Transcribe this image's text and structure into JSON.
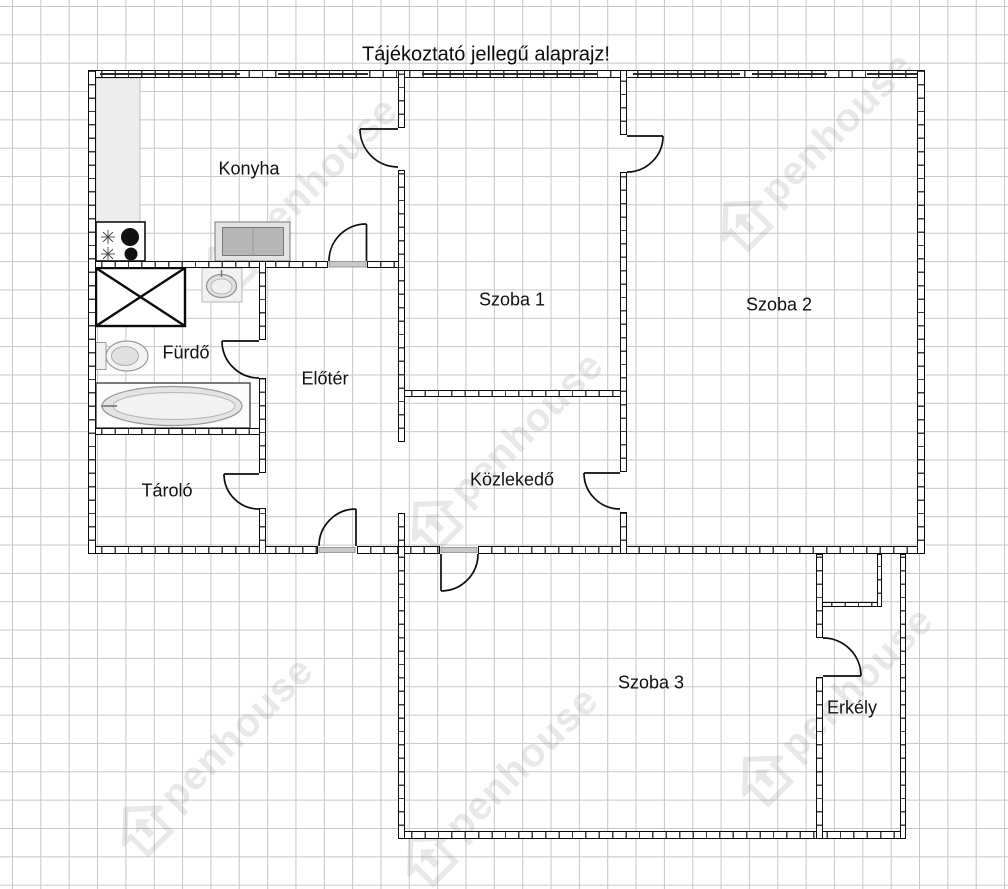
{
  "title": "Tájékoztató jellegű alaprajz!",
  "watermark": {
    "brand": "Openhouse",
    "display_text": "penhouse"
  },
  "rooms": [
    {
      "id": "konyha",
      "label": "Konyha"
    },
    {
      "id": "szoba-1",
      "label": "Szoba 1"
    },
    {
      "id": "szoba-2",
      "label": "Szoba 2"
    },
    {
      "id": "furdo",
      "label": "Fürdő"
    },
    {
      "id": "eloter",
      "label": "Előtér"
    },
    {
      "id": "kozlekedo",
      "label": "Közlekedő"
    },
    {
      "id": "tarolo",
      "label": "Tároló"
    },
    {
      "id": "szoba-3",
      "label": "Szoba 3"
    },
    {
      "id": "erkely",
      "label": "Erkély"
    }
  ],
  "fixtures": [
    "kitchen-counter",
    "stove",
    "kitchen-sink",
    "utility-shaft",
    "washbasin",
    "toilet",
    "bathtub"
  ],
  "doors": [
    "konyha-szoba1",
    "eloter-konyha",
    "szoba1-szoba2",
    "furdo",
    "tarolo",
    "kozlekedo-szoba2",
    "entrance",
    "szoba3",
    "erkely"
  ],
  "colors": {
    "wall": "#0a0a0a",
    "grid": "#c6c6c6",
    "watermark": "#777777",
    "threshold": "#c9c9c9"
  }
}
